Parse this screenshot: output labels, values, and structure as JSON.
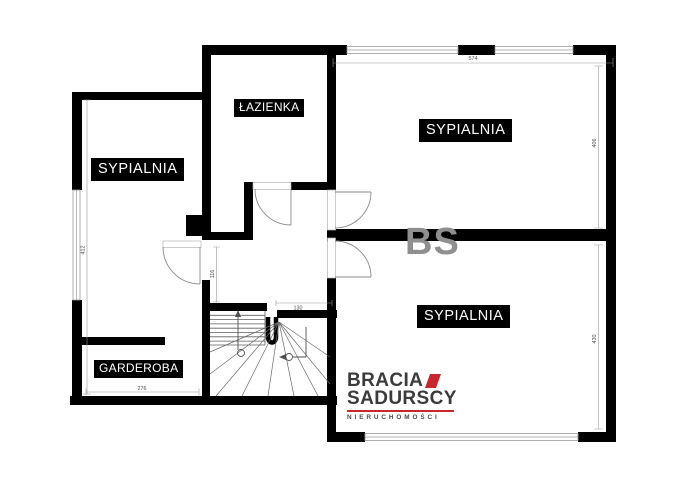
{
  "plan": {
    "watermark": "BS",
    "labels": {
      "lazienka": "ŁAZIENKA",
      "sypialnia_top": "SYPIALNIA",
      "sypialnia_left": "SYPIALNIA",
      "sypialnia_bottom": "SYPIALNIA",
      "garderoba": "GARDEROBA"
    },
    "dimensions": {
      "top_width": "574",
      "right_upper": "406",
      "right_lower": "430",
      "left_height": "412",
      "garderoba_width": "276",
      "hall_depth": "116",
      "stair_opening": "130"
    }
  },
  "logo": {
    "line1": "BRACIA",
    "line2": "SADURSCY",
    "tagline": "NIERUCHOMOŚCI"
  },
  "colors": {
    "wall": "#000000",
    "background": "#ffffff",
    "accent_red": "#c6282e",
    "logo_dark": "#3b3b3d",
    "watermark_gray": "#8f8f8f"
  }
}
